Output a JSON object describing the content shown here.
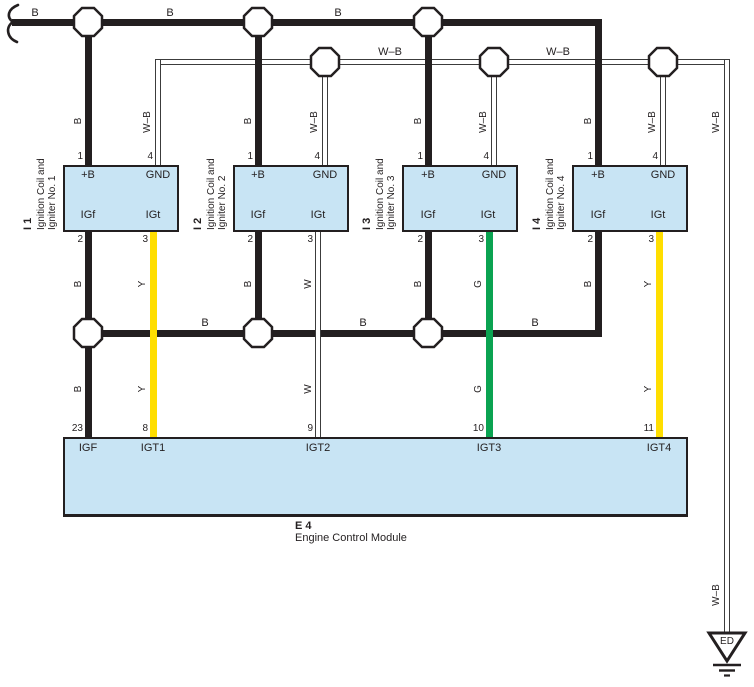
{
  "labels": {
    "b": "B",
    "wb": "W–B",
    "y": "Y",
    "w": "W",
    "g": "G"
  },
  "coil_terminals": {
    "plus_b": "+B",
    "gnd": "GND",
    "igf": "IGf",
    "igt": "IGt"
  },
  "coil_pins": {
    "plus_b": "1",
    "gnd": "4",
    "igf": "2",
    "igt": "3"
  },
  "coils": [
    {
      "id": "I 1",
      "name_line1": "Ignition Coil and",
      "name_line2": "Igniter No. 1"
    },
    {
      "id": "I 2",
      "name_line1": "Ignition Coil and",
      "name_line2": "Igniter No. 2"
    },
    {
      "id": "I 3",
      "name_line1": "Ignition Coil and",
      "name_line2": "Igniter No. 3"
    },
    {
      "id": "I 4",
      "name_line1": "Ignition Coil and",
      "name_line2": "Igniter No. 4"
    }
  ],
  "ecm": {
    "id": "E 4",
    "name": "Engine Control Module",
    "pins": [
      {
        "number": "23",
        "label": "IGF"
      },
      {
        "number": "8",
        "label": "IGT1"
      },
      {
        "number": "9",
        "label": "IGT2"
      },
      {
        "number": "10",
        "label": "IGT3"
      },
      {
        "number": "11",
        "label": "IGT4"
      }
    ]
  },
  "ground": {
    "label": "ED"
  },
  "wire_colors": {
    "B": "#231F20",
    "Y": "#FFDE00",
    "G": "#0AA351",
    "W": "#FFFFFF",
    "W-B": "#FFFFFF"
  },
  "component_fill": "#C8E4F4"
}
